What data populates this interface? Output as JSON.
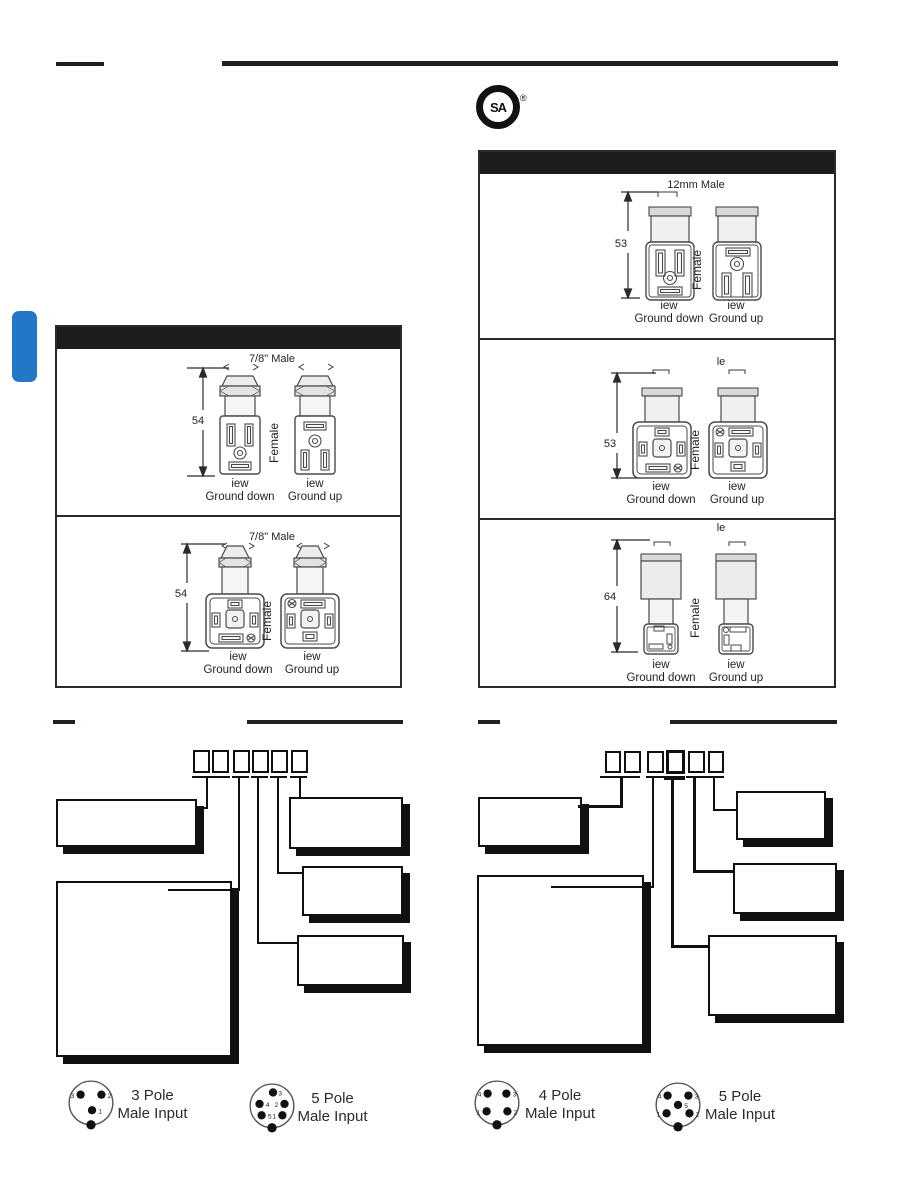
{
  "csa": {
    "letters": "SA",
    "registered": "®"
  },
  "colors": {
    "accent_blue": "#2277c8",
    "ink": "#231f20"
  },
  "left_panel": {
    "sections": [
      {
        "male_label": "7/8\" Male",
        "height_dim": "54"
      },
      {
        "male_label": "7/8\" Male",
        "height_dim": "54"
      }
    ]
  },
  "right_panel": {
    "sections": [
      {
        "male_label": "12mm Male",
        "height_dim": "53"
      },
      {
        "male_label": "le",
        "height_dim": "53"
      },
      {
        "male_label": "le",
        "height_dim": "64"
      }
    ]
  },
  "labels": {
    "female": "Female",
    "view": "iew",
    "ground_down": "Ground down",
    "ground_up": "Ground up"
  },
  "pinouts": {
    "left_tree": [
      {
        "poles": "3 Pole",
        "title": "Male Input",
        "pins": [
          "3",
          "2",
          "1"
        ]
      },
      {
        "poles": "5 Pole",
        "title": "Male Input",
        "pins": [
          "3",
          "4",
          "2",
          "5",
          "1"
        ]
      }
    ],
    "right_tree": [
      {
        "poles": "4 Pole",
        "title": "Male Input",
        "pins": [
          "4",
          "3",
          "1",
          "2"
        ]
      },
      {
        "poles": "5 Pole",
        "title": "Male Input",
        "pins": [
          "4",
          "3",
          "5",
          "1",
          "2"
        ]
      }
    ]
  }
}
